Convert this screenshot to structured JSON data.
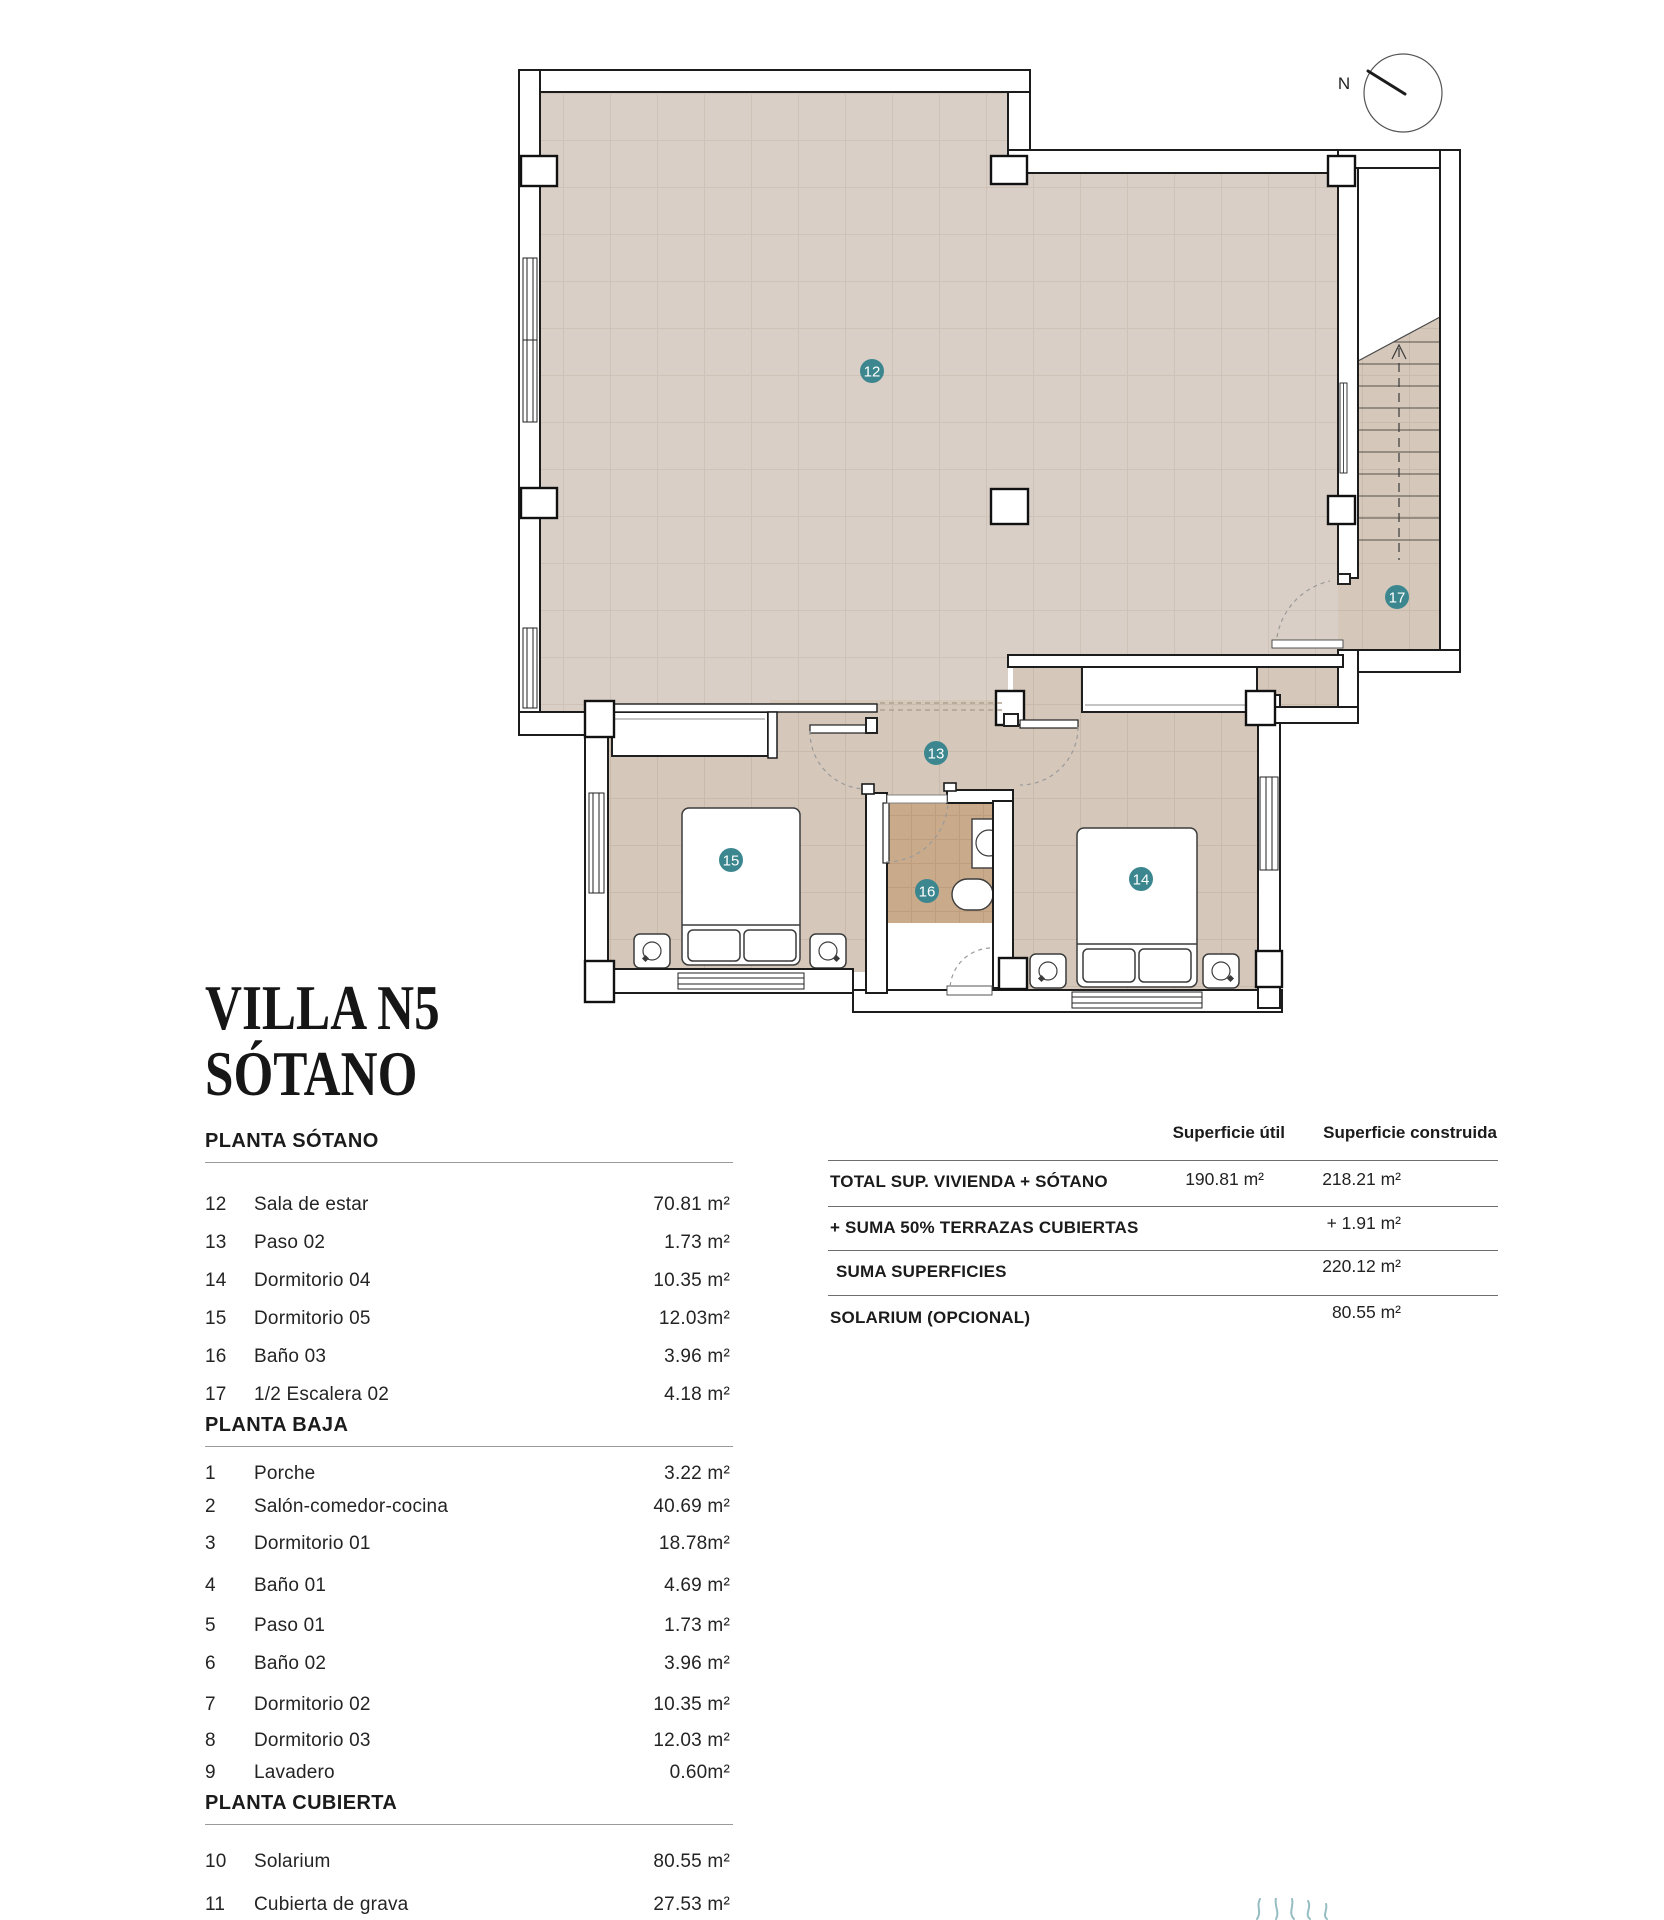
{
  "title": {
    "line1": "VILLA N5",
    "line2": "SÓTANO"
  },
  "plan": {
    "north_label": "N",
    "badge_color": "#3c878f",
    "floor_color_main": "#d9cfc6",
    "floor_color_rooms": "#d5c8bb",
    "floor_color_bath": "#c9ab8b",
    "badges": [
      {
        "label": "12"
      },
      {
        "label": "13"
      },
      {
        "label": "14"
      },
      {
        "label": "15"
      },
      {
        "label": "16"
      },
      {
        "label": "17"
      }
    ]
  },
  "tables": {
    "left_sections": [
      {
        "header": "PLANTA SÓTANO",
        "rows": [
          {
            "num": "12",
            "name": "Sala de estar",
            "area": "70.81 m²"
          },
          {
            "num": "13",
            "name": "Paso 02",
            "area": "1.73 m²"
          },
          {
            "num": "14",
            "name": "Dormitorio 04",
            "area": "10.35 m²"
          },
          {
            "num": "15",
            "name": "Dormitorio 05",
            "area": "12.03m²"
          },
          {
            "num": "16",
            "name": "Baño 03",
            "area": "3.96 m²"
          },
          {
            "num": "17",
            "name": "1/2 Escalera 02",
            "area": "4.18 m²"
          }
        ]
      },
      {
        "header": "PLANTA BAJA",
        "rows": [
          {
            "num": "1",
            "name": "Porche",
            "area": "3.22 m²"
          },
          {
            "num": "2",
            "name": "Salón-comedor-cocina",
            "area": "40.69 m²"
          },
          {
            "num": "3",
            "name": "Dormitorio 01",
            "area": "18.78m²"
          },
          {
            "num": "4",
            "name": "Baño 01",
            "area": "4.69 m²"
          },
          {
            "num": "5",
            "name": "Paso 01",
            "area": "1.73 m²"
          },
          {
            "num": "6",
            "name": "Baño 02",
            "area": "3.96 m²"
          },
          {
            "num": "7",
            "name": "Dormitorio 02",
            "area": "10.35 m²"
          },
          {
            "num": "8",
            "name": "Dormitorio 03",
            "area": "12.03 m²"
          },
          {
            "num": "9",
            "name": "Lavadero",
            "area": "0.60m²"
          }
        ]
      },
      {
        "header": "PLANTA CUBIERTA",
        "rows": [
          {
            "num": "10",
            "name": "Solarium",
            "area": "80.55 m²"
          },
          {
            "num": "11",
            "name": "Cubierta de grava",
            "area": "27.53 m²"
          }
        ]
      }
    ],
    "summary": {
      "col_util": "Superficie útil",
      "col_built": "Superficie construida",
      "rows": [
        {
          "label": "TOTAL SUP. VIVIENDA + SÓTANO",
          "util": "190.81  m²",
          "built": "218.21 m²"
        },
        {
          "label": "+ SUMA 50% TERRAZAS CUBIERTAS",
          "util": "",
          "built": "+ 1.91 m²"
        },
        {
          "label": "SUMA SUPERFICIES",
          "util": "",
          "built": "220.12 m²"
        },
        {
          "label": "SOLARIUM (OPCIONAL)",
          "util": "",
          "built": "80.55 m²"
        }
      ]
    }
  }
}
